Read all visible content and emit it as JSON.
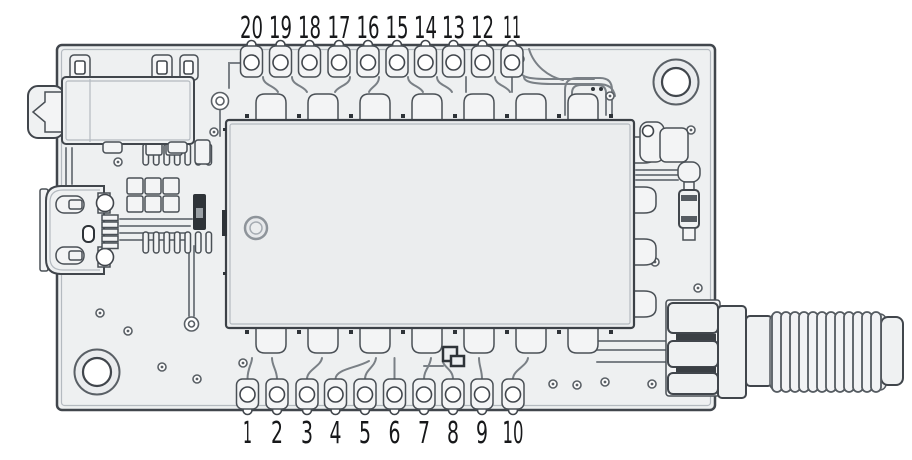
{
  "diagram": {
    "type": "pcb-pinout",
    "description": "Top view of an RF module PCB with numbered castellated pins",
    "pins": {
      "top": [
        "20",
        "19",
        "18",
        "17",
        "16",
        "15",
        "14",
        "13",
        "12",
        "11"
      ],
      "bottom": [
        "1",
        "2",
        "3",
        "4",
        "5",
        "6",
        "7",
        "8",
        "9",
        "10"
      ]
    },
    "parts": {
      "audio_jack": "audio-jack",
      "usb_connector": "micro-usb",
      "rf_module": "shielded-rf-module",
      "antenna_connector": "sma-female",
      "mounting_holes": 2
    },
    "colors": {
      "background": "#ffffff",
      "board": "#eef0f1",
      "module": "#ebedee",
      "outline": "#41464c",
      "pad": "#f3f4f5",
      "hole": "#ffffff",
      "trace": "#7a8086",
      "dark_component": "#2e3338",
      "text": "#17181a"
    }
  }
}
